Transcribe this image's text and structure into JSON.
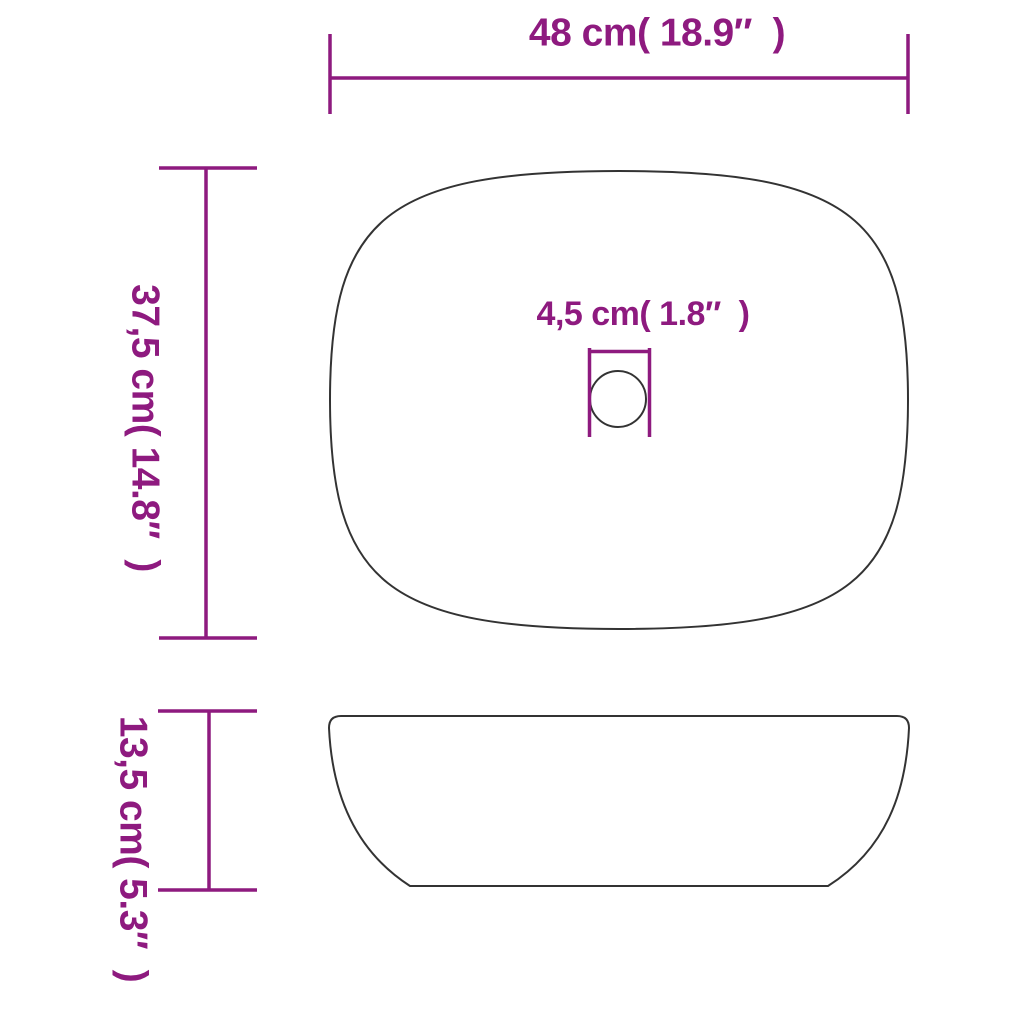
{
  "diagram_title": "washbasin-dimension-diagram",
  "colors": {
    "accent": "#8e1a7f",
    "outline": "#333333",
    "background": "#ffffff"
  },
  "labels": {
    "width": "48 cm( 18.9″  )",
    "depth": "37,5 cm( 14.8″  )",
    "drain": "4,5 cm( 1.8″  )",
    "height": "13,5 cm( 5.3″  )"
  },
  "measurements": {
    "width": {
      "cm": "48",
      "inches": "18.9"
    },
    "depth": {
      "cm": "37,5",
      "inches": "14.8"
    },
    "drain_diameter": {
      "cm": "4,5",
      "inches": "1.8"
    },
    "height": {
      "cm": "13,5",
      "inches": "5.3"
    }
  }
}
